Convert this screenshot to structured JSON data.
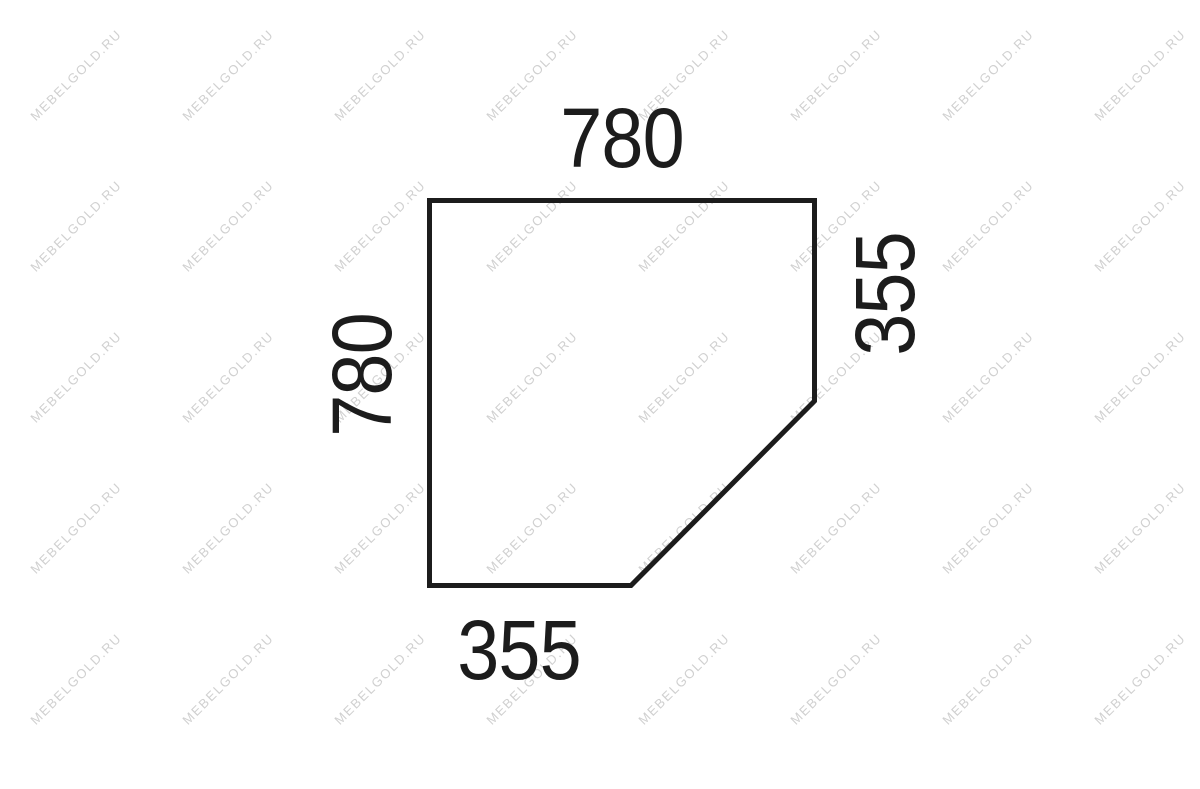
{
  "page": {
    "width_px": 1200,
    "height_px": 789,
    "background_color": "#ffffff"
  },
  "diagram": {
    "kind": "furniture-panel-dimension-drawing",
    "shape": "pentagon-corner-panel",
    "outline_color": "#1c1c1c",
    "label_color": "#1c1c1c",
    "labels": {
      "top": "780",
      "right": "355",
      "bottom": "355",
      "left": "780"
    }
  },
  "watermark": {
    "text": "MEBELGOLD.RU",
    "color": "#d0d0d0",
    "rotation_deg": -45,
    "grid": {
      "x_start": 76,
      "y_start": 75,
      "x_step": 152,
      "y_step": 151,
      "columns": 8,
      "rows": 5
    }
  }
}
